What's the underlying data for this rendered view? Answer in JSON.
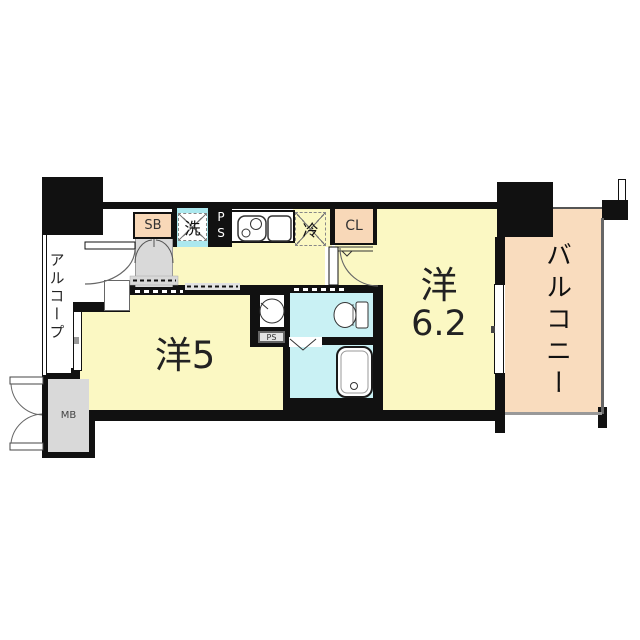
{
  "title": "1K apartment floor plan",
  "rooms": {
    "alcove": {
      "label": "アルコープ"
    },
    "balcony": {
      "label": "バルコニー"
    },
    "western_5": {
      "label": "洋5"
    },
    "western_6_2": {
      "line1": "洋",
      "line2": "6.2"
    }
  },
  "fixtures": {
    "shoe_box": "SB",
    "closet": "CL",
    "washer": "洗",
    "fridge": "冷",
    "pipe_space_kitchen": "PS",
    "pipe_space_sanitary": "PS",
    "meter_box": "MB"
  },
  "icons": {
    "stove": "two-burner-stove-icon",
    "sink": "kitchen-sink-icon",
    "washbasin": "round-washbasin-icon",
    "toilet": "toilet-icon",
    "bathtub": "bathtub-icon"
  },
  "colors": {
    "wall": "#111111",
    "room_yellow": "#FBF8C3",
    "balcony_peach": "#F9DCBE",
    "cabinet_peach": "#F8D8B8",
    "wet_area_cyan": "#C9F1F4",
    "entry_gray": "#D9D9D9",
    "washer_band_cyan": "#ABE8EE"
  }
}
